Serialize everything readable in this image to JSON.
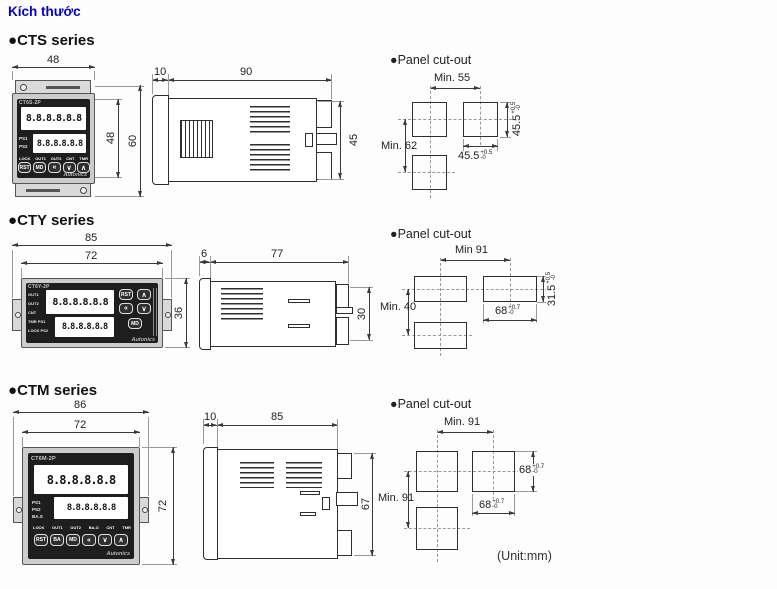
{
  "page": {
    "title": "Kích thước",
    "bullet": "●",
    "unit_note": "(Unit:mm)",
    "colors": {
      "title_link": "#0000cc",
      "line": "#3a3a3a",
      "device_bezel": "#cccccc",
      "device_face": "#1e1e1e",
      "lcd_bg": "#ffffff"
    }
  },
  "cts": {
    "heading": "CTS series",
    "front": {
      "model": "CT6S-2P",
      "display_top": "8.8.8.8.8.8",
      "display_bottom": "8.8.8.8.8.8",
      "ind1": "PS1",
      "ind2": "PS2",
      "status": [
        "LOCK",
        "OUT1",
        "OUT2",
        "CNT",
        "TMR"
      ],
      "buttons": [
        "RST",
        "MD",
        "«",
        "∨",
        "∧"
      ],
      "brand": "Autonics",
      "dim_width": "48",
      "dim_height_inner": "48",
      "dim_height_outer": "60"
    },
    "side": {
      "dim_bezel": "10",
      "dim_depth": "90",
      "dim_height": "45"
    },
    "cutout": {
      "heading": "Panel cut-out",
      "h_span": "Min. 55",
      "v_span": "Min. 62",
      "w_val": "45.5",
      "w_tol_plus": "+0.5",
      "w_tol_minus": "-0",
      "h_val": "45.5",
      "h_tol_plus": "+0.5",
      "h_tol_minus": "-0"
    }
  },
  "cty": {
    "heading": "CTY series",
    "front": {
      "model": "CT6Y-2P",
      "display_top": "8.8.8.8.8.8",
      "display_bottom": "8.8.8.8.8.8",
      "rows": [
        "OUT1",
        "OUT2",
        "CNT",
        "TMR PS1",
        "LOCK PS2"
      ],
      "buttons": [
        "RST",
        "∧",
        "«",
        "∨",
        "MD"
      ],
      "brand": "Autonics",
      "dim_width_outer": "85",
      "dim_width_inner": "72",
      "dim_height": "36"
    },
    "side": {
      "dim_bezel": "6",
      "dim_depth": "77",
      "dim_height": "30"
    },
    "cutout": {
      "heading": "Panel cut-out",
      "h_span": "Min 91",
      "v_span": "Min. 40",
      "w_val": "68",
      "w_tol_plus": "+0.7",
      "w_tol_minus": "-0",
      "h_val": "31.5",
      "h_tol_plus": "+0.5",
      "h_tol_minus": "-0"
    }
  },
  "ctm": {
    "heading": "CTM series",
    "front": {
      "model": "CT6M-2P",
      "display_top": "8.8.8.8.8.8",
      "display_bottom": "8.8.8.8.8.8",
      "inds": [
        "PS1",
        "PS2",
        "BA.S"
      ],
      "status": [
        "LOCK",
        "OUT1",
        "OUT2",
        "BA.O",
        "CNT",
        "TMR"
      ],
      "buttons": [
        "RST",
        "BA",
        "MD",
        "«",
        "∨",
        "∧"
      ],
      "brand": "Autonics",
      "dim_width_outer": "86",
      "dim_width_inner": "72",
      "dim_height": "72"
    },
    "side": {
      "dim_bezel": "10",
      "dim_depth": "85",
      "dim_height": "67"
    },
    "cutout": {
      "heading": "Panel cut-out",
      "h_span": "Min. 91",
      "v_span": "Min. 91",
      "w_val": "68",
      "w_tol_plus": "+0.7",
      "w_tol_minus": "-0",
      "h_val": "68",
      "h_tol_plus": "+0.7",
      "h_tol_minus": "-0"
    }
  }
}
